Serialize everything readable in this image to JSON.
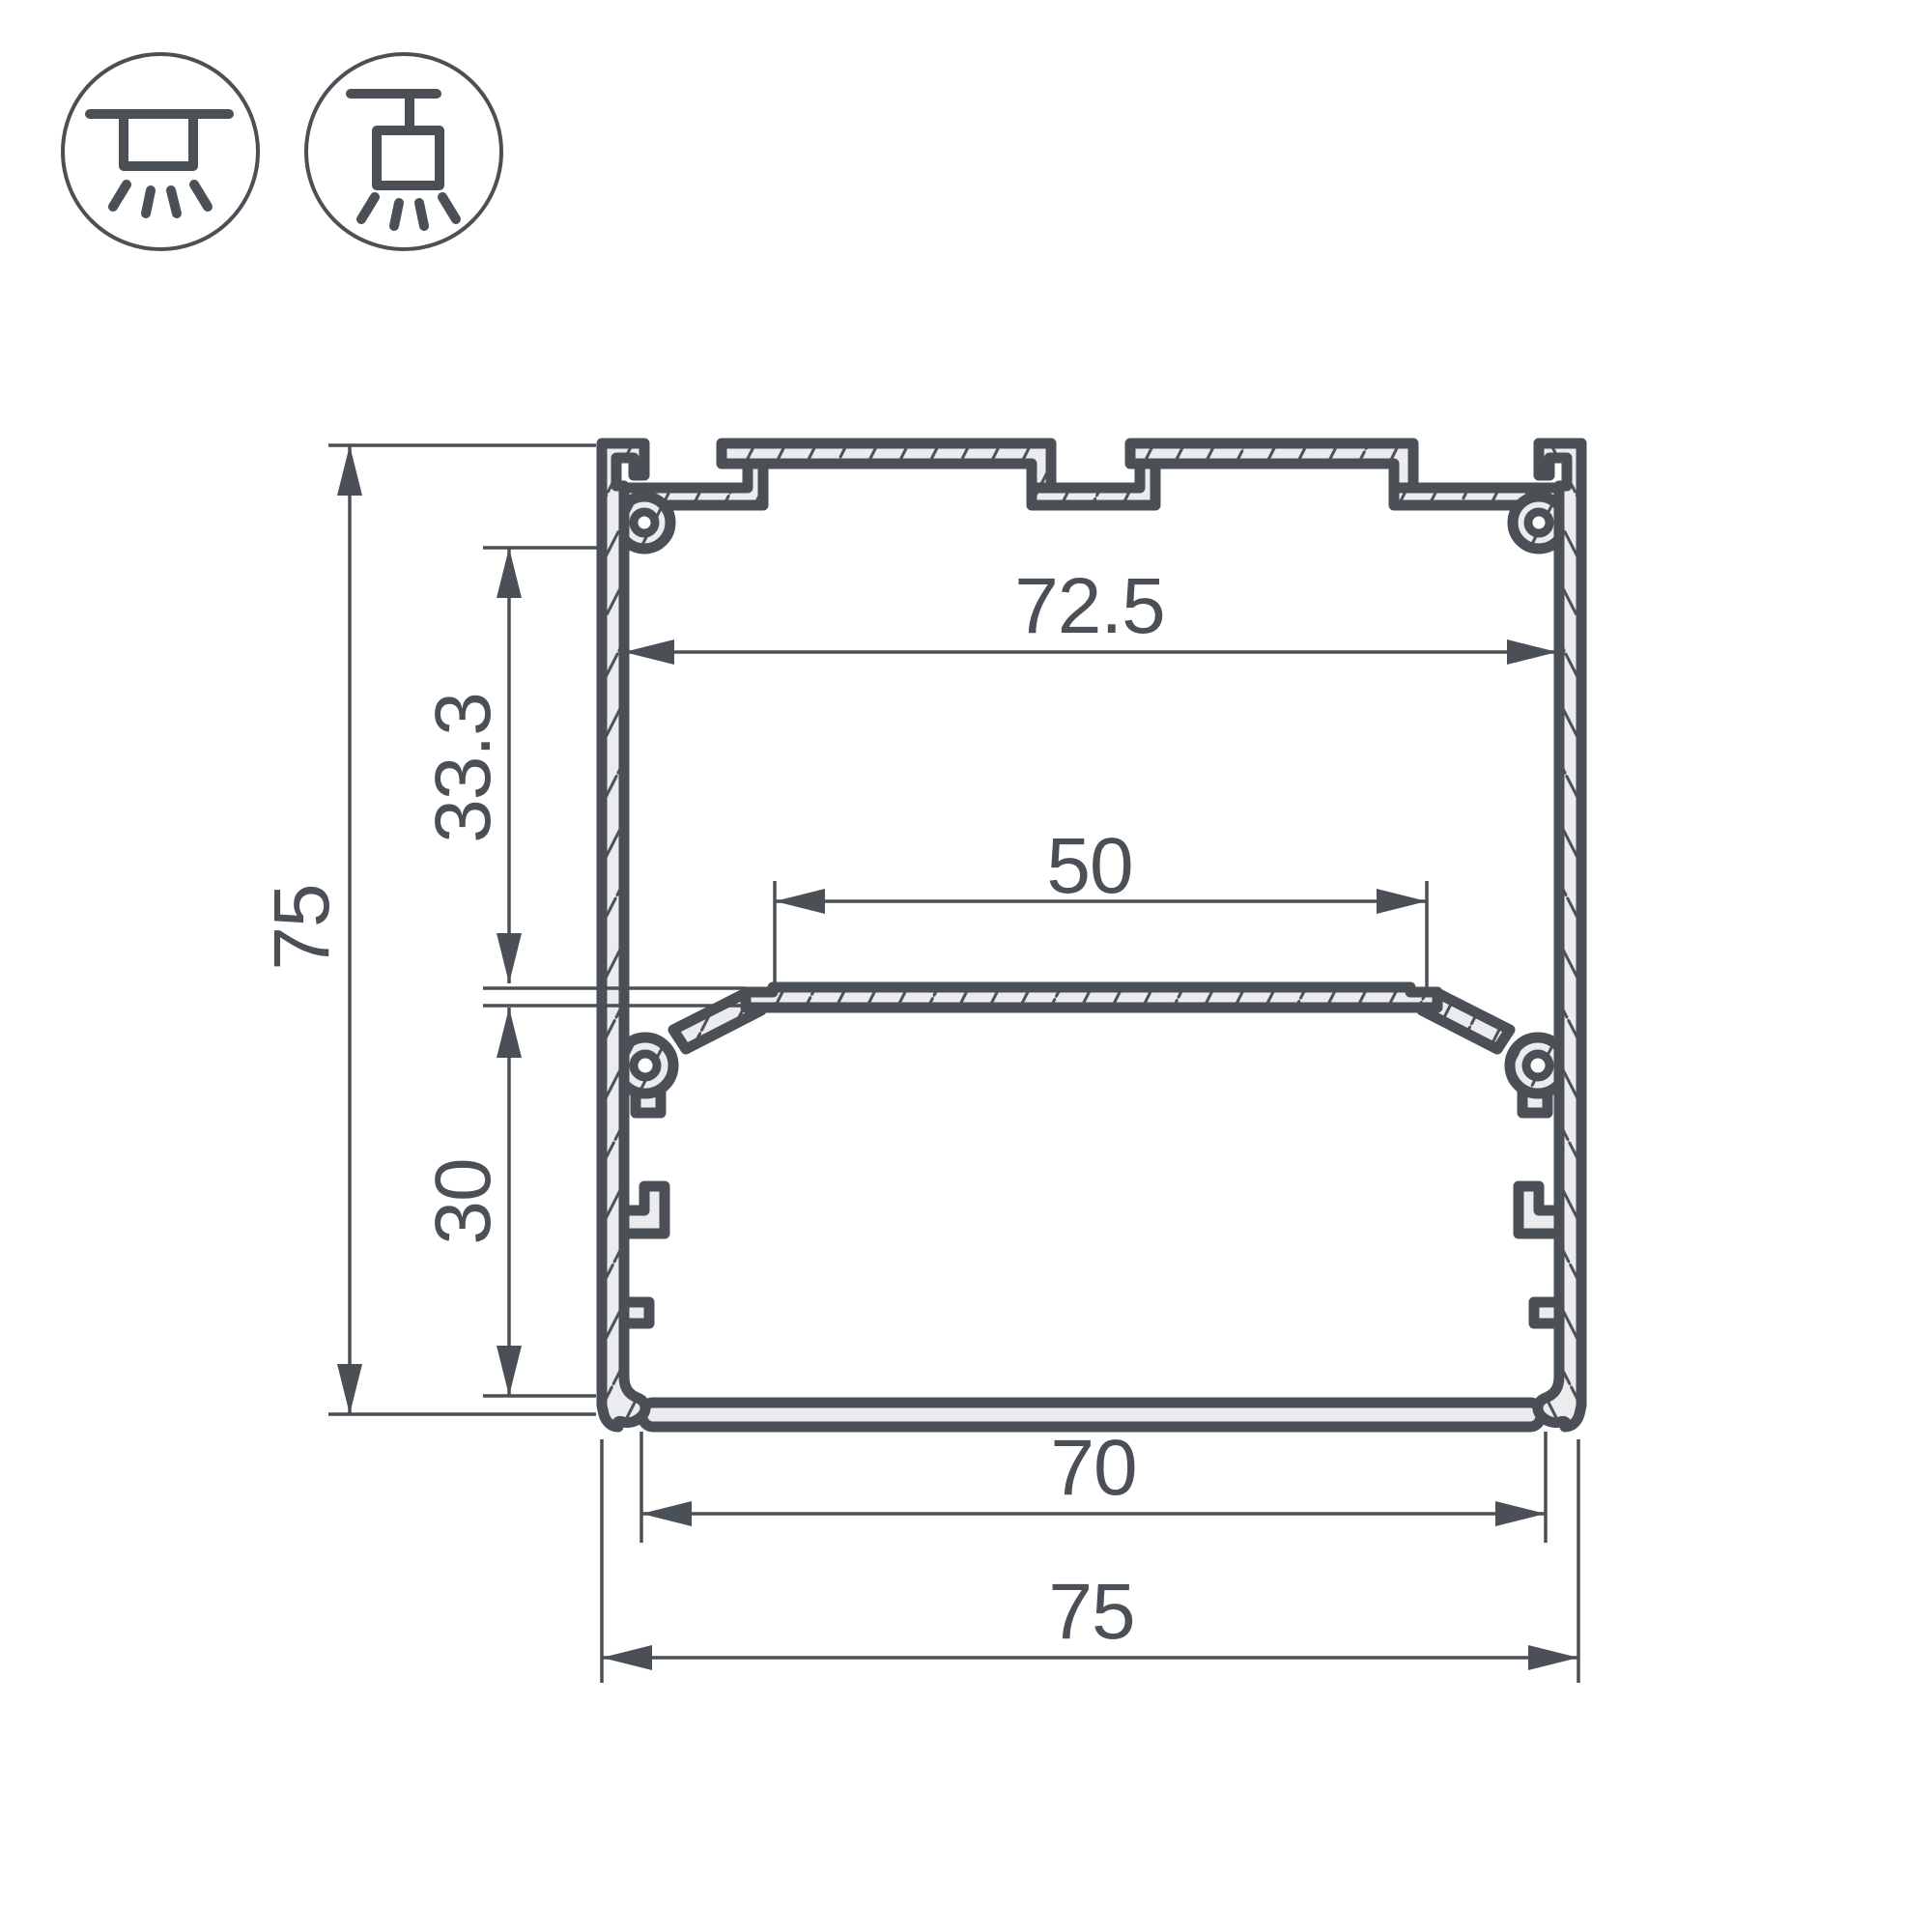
{
  "drawing": {
    "type": "technical-cross-section",
    "subject": "aluminum LED profile cross-section with dimensions",
    "units_implied": "mm"
  },
  "colors": {
    "line": "#4a5056",
    "fill": "#ececee",
    "background": "#ffffff"
  },
  "icons": [
    {
      "name": "surface-mount-icon"
    },
    {
      "name": "pendant-mount-icon"
    }
  ],
  "dimensions": {
    "top_inner_width": "72.5",
    "upper_section_depth": "33.3",
    "overall_height": "75",
    "shelf_width": "50",
    "lower_section_depth": "30",
    "bottom_inner_width": "70",
    "overall_width": "75"
  }
}
